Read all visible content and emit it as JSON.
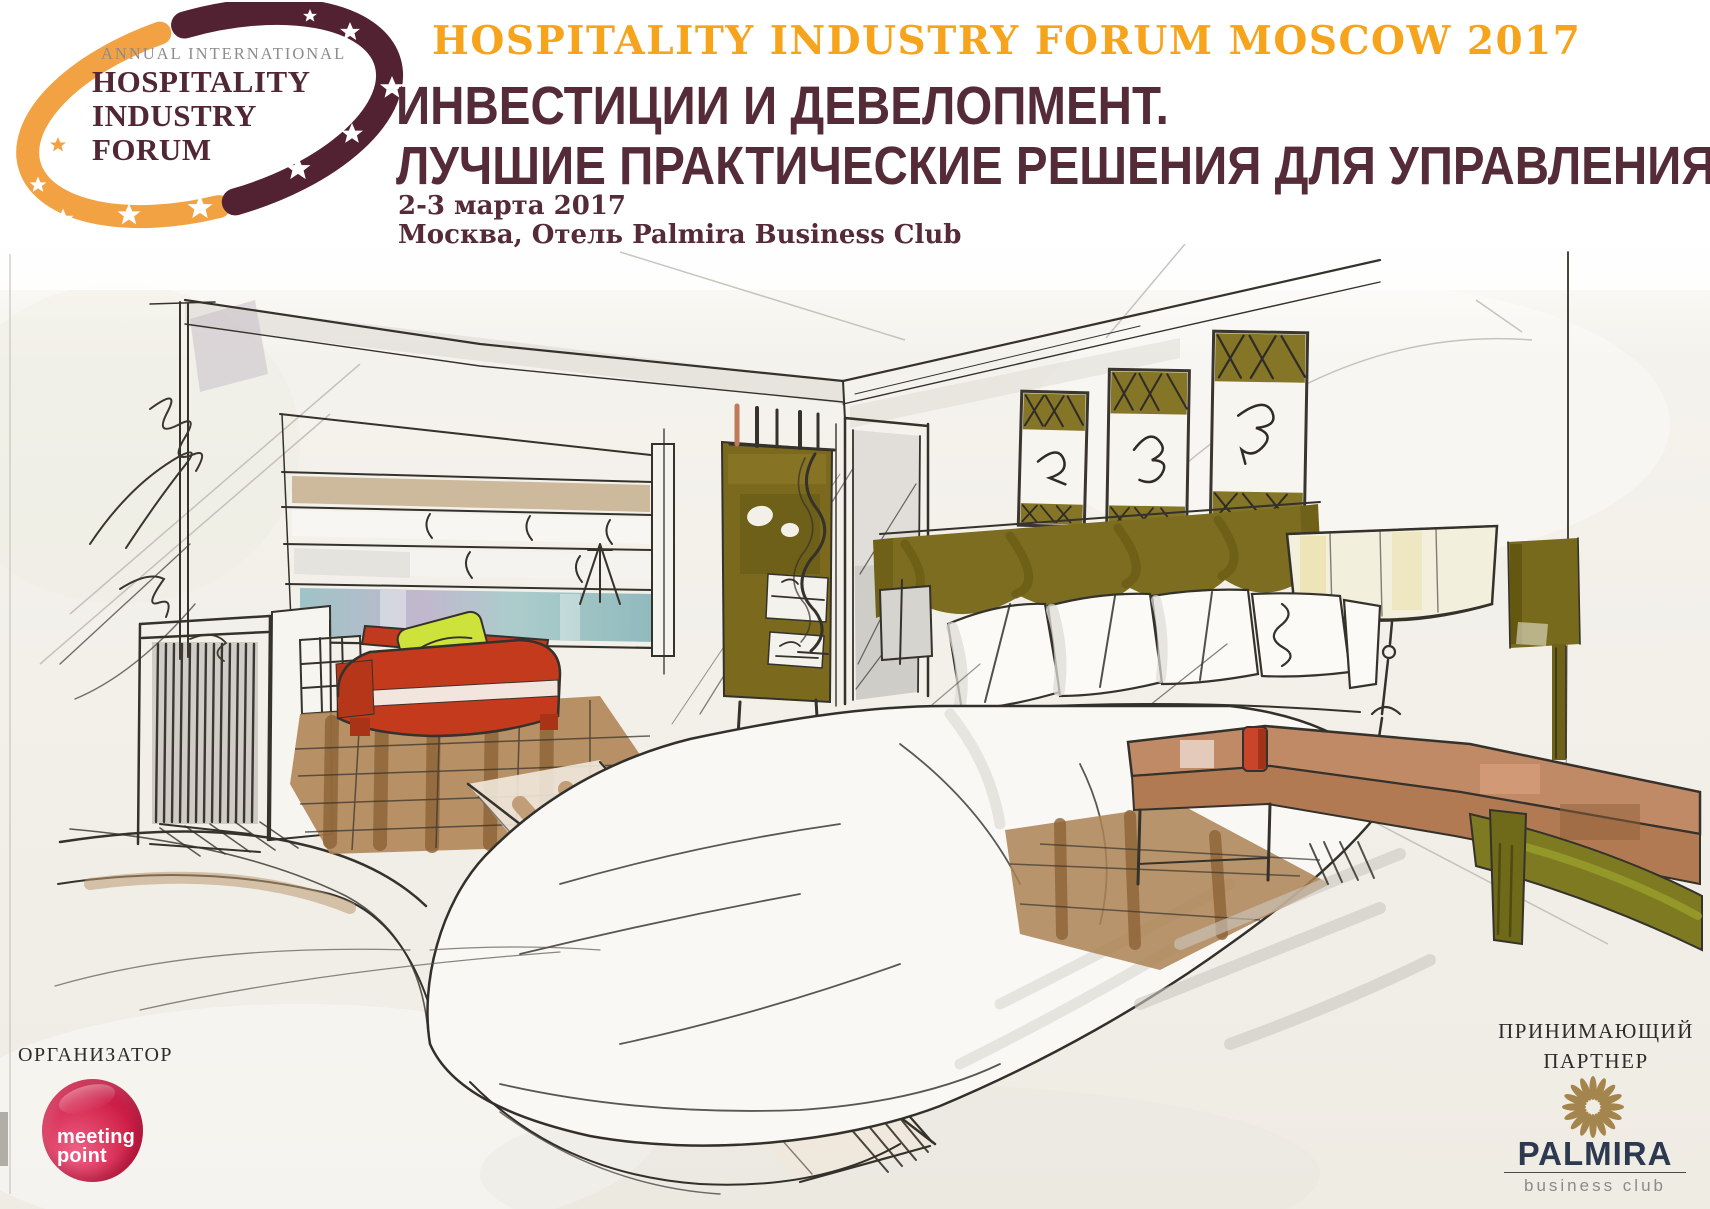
{
  "event": {
    "title_en": "HOSPITALITY INDUSTRY FORUM MOSCOW 2017",
    "subtitle_line1": "ИНВЕСТИЦИИ И ДЕВЕЛОПМЕНТ.",
    "subtitle_line2": "ЛУЧШИЕ ПРАКТИЧЕСКИЕ РЕШЕНИЯ ДЛЯ УПРАВЛЕНИЯ",
    "dates": "2-3 марта 2017",
    "venue": "Москва, Отель Palmira Business Club"
  },
  "logo": {
    "tagline": "ANNUAL INTERNATIONAL",
    "line1": "HOSPITALITY",
    "line2": "INDUSTRY",
    "line3": "FORUM"
  },
  "organizer": {
    "label": "ОРГАНИЗАТОР",
    "logo_line1": "meeting",
    "logo_line2": "point"
  },
  "partner": {
    "label_line1": "ПРИНИМАЮЩИЙ",
    "label_line2": "ПАРТНЕР",
    "logo_name": "PALMIRA",
    "logo_tagline": "business club"
  },
  "illustration": {
    "description": "Hand-drawn marker sketch of a hotel room interior: bed with white duvet and pillows, olive valance and framed pictures, red armchair with yellow pillow, fireplace, shelving with linens, wardrobe, drum lampshade on a wooden table"
  },
  "colors": {
    "accent_orange": "#F7A41D",
    "brand_maroon": "#562B38",
    "organizer_crimson": "#CE1A43",
    "partner_gold": "#A5854E",
    "partner_navy": "#2D3950",
    "sketch_olive": "#7B6A1E",
    "sketch_red_chair": "#C33A1D",
    "sketch_wood": "#B08557"
  }
}
